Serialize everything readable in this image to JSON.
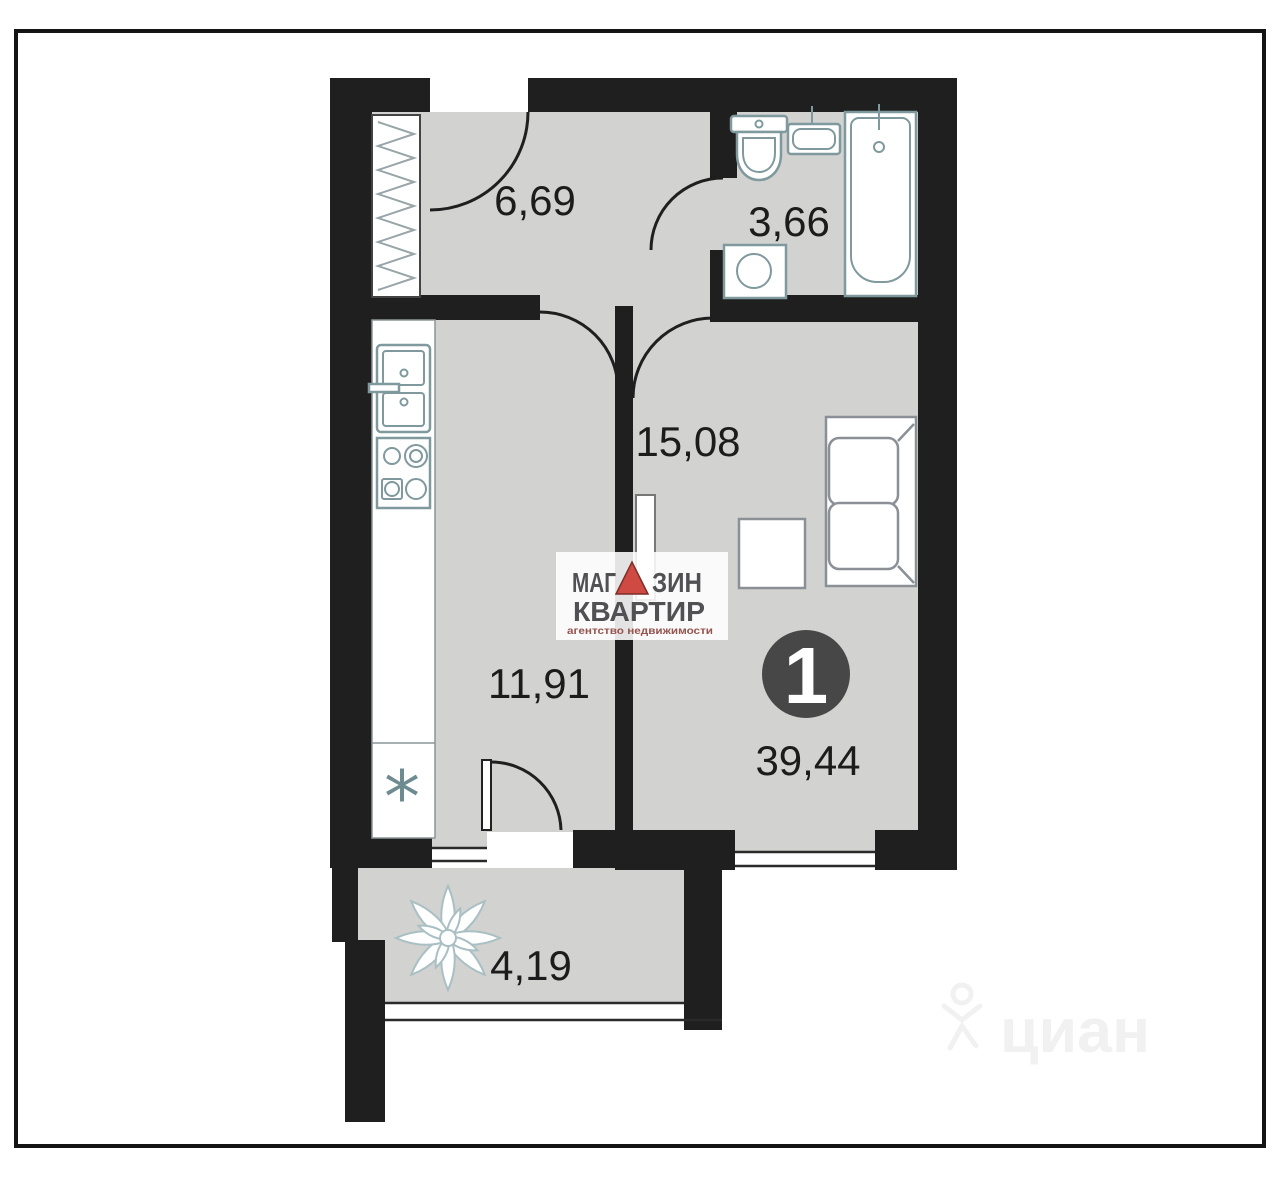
{
  "plan": {
    "type": "apartment-floor-plan",
    "rooms": {
      "hallway": {
        "area": "6,69"
      },
      "bathroom": {
        "area": "3,66"
      },
      "living_room": {
        "area": "15,08"
      },
      "kitchen": {
        "area": "11,91"
      },
      "balcony": {
        "area": "4,19"
      }
    },
    "apartment": {
      "rooms_badge": "1",
      "total_area": "39,44"
    },
    "symbols": {
      "boiler_mark": "*"
    }
  },
  "logo": {
    "word1_left": "МАГ",
    "word1_right": "ЗИН",
    "word2": "КВАРТИР",
    "tagline": "агентство недвижимости"
  },
  "watermark": {
    "text": "циан"
  },
  "colors": {
    "wall": "#1f1f1f",
    "floor": "#d2d2d0",
    "fixture_stroke": "#7f999e",
    "furniture_stroke": "#8a9096",
    "accent_red": "#cf4a42",
    "logo_text": "#515154",
    "badge_fill": "#474747",
    "frame": "#141414"
  }
}
